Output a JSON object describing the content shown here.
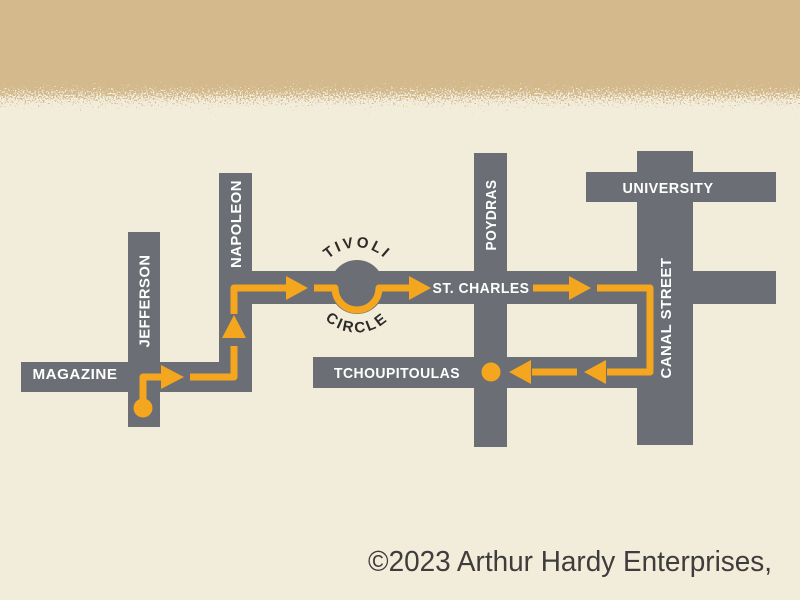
{
  "map": {
    "colors": {
      "background": "#F2ECDB",
      "texture_band": "#D3B98C",
      "street": "#6B6E74",
      "route": "#F4A61E",
      "street_label": "#FFFFFF",
      "circle_label": "#2C2B28",
      "copyright": "#3E3D3B"
    },
    "streets": {
      "magazine": "MAGAZINE",
      "jefferson": "JEFFERSON",
      "napoleon": "NAPOLEON",
      "st_charles": "ST. CHARLES",
      "poydras": "POYDRAS",
      "tchoupitoulas": "TCHOUPITOULAS",
      "university": "UNIVERSITY",
      "canal_street": "CANAL STREET"
    },
    "tivoli": {
      "top": "TIVOLI",
      "bottom": "CIRCLE"
    },
    "footer": {
      "copyright": "©2023 Arthur Hardy Enterprises,"
    }
  }
}
